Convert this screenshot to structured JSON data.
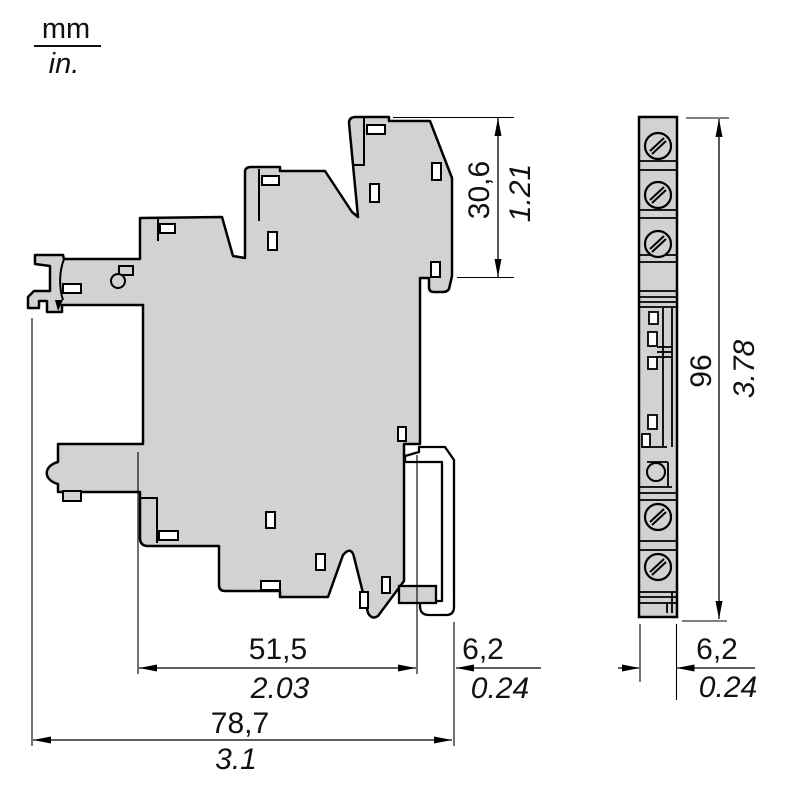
{
  "legend": {
    "metric": "mm",
    "imperial": "in."
  },
  "colors": {
    "body_fill": "#d2d2d2",
    "line": "#000000",
    "background": "#ffffff"
  },
  "side_view": {
    "dim_top_height": {
      "mm": "30,6",
      "in": "1.21"
    },
    "dim_depth": {
      "mm": "51,5",
      "in": "2.03"
    },
    "dim_rail": {
      "mm": "6,2",
      "in": "0.24"
    },
    "dim_total_depth": {
      "mm": "78,7",
      "in": "3.1"
    }
  },
  "front_view": {
    "dim_height": {
      "mm": "96",
      "in": "3.78"
    },
    "dim_width": {
      "mm": "6,2",
      "in": "0.24"
    }
  }
}
